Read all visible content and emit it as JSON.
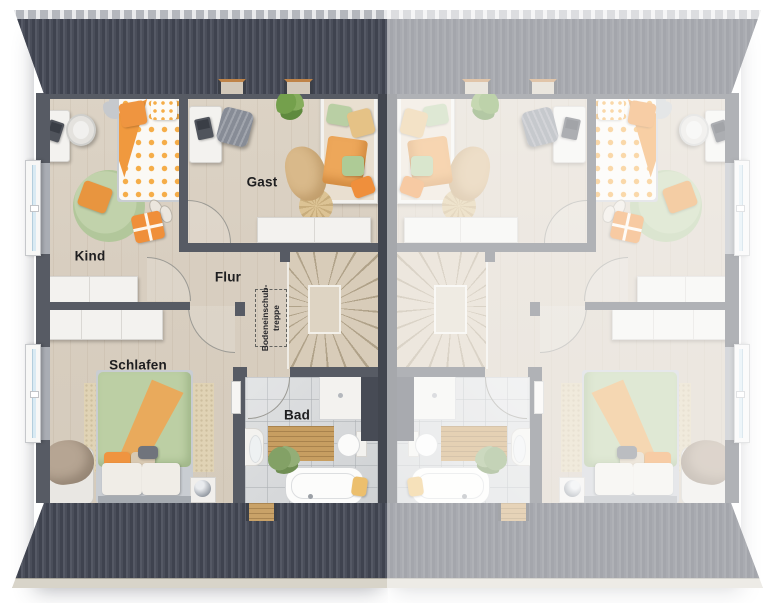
{
  "labels": {
    "kind": "Kind",
    "gast": "Gast",
    "flur": "Flur",
    "schlafen": "Schlafen",
    "bad": "Bad"
  },
  "attic_hatch": {
    "line1": "Bodeneinschub-",
    "line2": "treppe"
  },
  "colors": {
    "roof": "#4a4e5a",
    "walls": "#575b64",
    "party_wall": "#42464f",
    "floor_wood": "#d9d0c2",
    "bath_tile": "#d8dadb",
    "accent_orange": "#f0943e",
    "accent_sage": "#bccfa4",
    "fade_overlay": "rgba(255,255,255,0.53)"
  }
}
